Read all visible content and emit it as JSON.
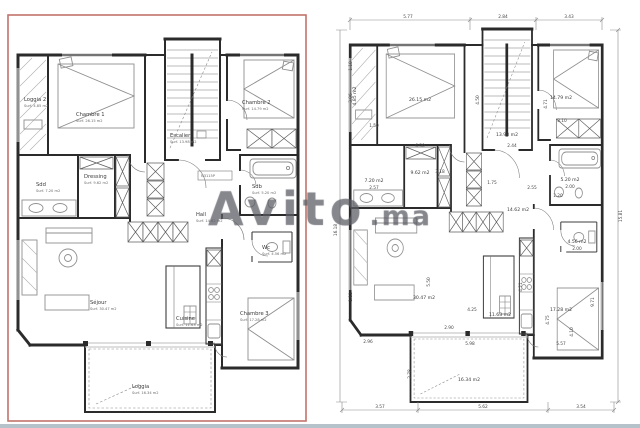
{
  "watermark": {
    "brand": "Avito",
    "tld": ".ma"
  },
  "left_plan": {
    "rooms": [
      {
        "id": "loggia2",
        "name": "Loggia 2",
        "area": "Surf. 4.85 m2"
      },
      {
        "id": "chambre1",
        "name": "Chambre 1",
        "area": "Surf. 26.15 m2"
      },
      {
        "id": "chambre2",
        "name": "Chambre 2",
        "area": "Surf. 14.79 m2"
      },
      {
        "id": "escalier",
        "name": "Escalier",
        "area": "Surf. 13.98 m2"
      },
      {
        "id": "sdd",
        "name": "Sdd",
        "area": "Surf. 7.20 m2"
      },
      {
        "id": "dressing",
        "name": "Dressing",
        "area": "Surf. 9.62 m2"
      },
      {
        "id": "ref",
        "name": "N3115P",
        "area": ""
      },
      {
        "id": "sdb",
        "name": "Sdb",
        "area": "Surf. 5.20 m2"
      },
      {
        "id": "hall",
        "name": "Hall",
        "area": "Surf. 14.62 m2"
      },
      {
        "id": "wc",
        "name": "Wc",
        "area": "Surf. 4.56 m2"
      },
      {
        "id": "sejour",
        "name": "Séjour",
        "area": "Surf. 30.47 m2"
      },
      {
        "id": "cuisine",
        "name": "Cuisine",
        "area": "Surf. 11.63 m2"
      },
      {
        "id": "chambre3",
        "name": "Chambre 3",
        "area": "Surf. 17.28 m2"
      },
      {
        "id": "loggia",
        "name": "Loggia",
        "area": "Surf. 16.34 m2"
      }
    ]
  },
  "right_plan": {
    "areas": {
      "loggia2": "4.85 m2",
      "chambre1": "26.15 m2",
      "chambre2": "14.79 m2",
      "escalier": "13.98 m2",
      "sdd": "7.20 m2",
      "dressing": "9.62 m2",
      "sdb": "5.20 m2",
      "hall": "14.62 m2",
      "wc": "4.56 m2",
      "sejour": "30.47 m2",
      "cuisine": "11.63 m2",
      "chambre3": "17.28 m2",
      "loggia": "16.34 m2"
    },
    "subs": {
      "wc": "2.00",
      "sdb": "2.00"
    },
    "dims": {
      "top": [
        "5.77",
        "2.84",
        "3.43"
      ],
      "bottom": [
        "3.57",
        "5.62",
        "3.54"
      ],
      "left": "16.18",
      "right": "15.81",
      "inner": [
        "1.10",
        "3.06",
        "1.50",
        "6.50",
        "4.50",
        "2.44",
        "3.10",
        "4.71",
        "3.18",
        "2.57",
        "1.75",
        "2.55",
        "1.20",
        "5.50",
        "1.11",
        "4.21",
        "4.25",
        "2.90",
        "2.96",
        "9.71",
        "4.75",
        "4.10",
        "5.98",
        "2.78",
        "5.57"
      ]
    }
  }
}
